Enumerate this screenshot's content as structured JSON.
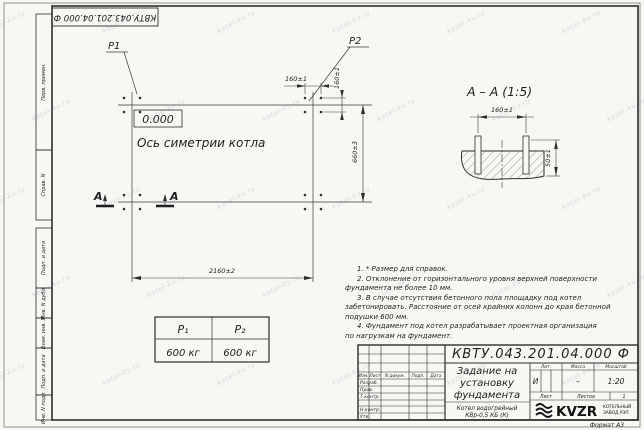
{
  "sheet": {
    "watermark": "kotel-kv.ru",
    "format": "Формат А3"
  },
  "top_stamp": {
    "doc_number": "КВТУ.043.201.04.000 Ф"
  },
  "sidebar": {
    "items": [
      "Перв. примен.",
      "Справ. N",
      "Подп. и дата",
      "Инв. N дубл.",
      "Взам. инв. N",
      "Подп. и дата",
      "Инв. N подл."
    ]
  },
  "plan": {
    "p1": "P1",
    "p2": "P2",
    "elevation": "0.000",
    "axis_label": "Ось симетрии котла",
    "section_letter_left": "А",
    "section_letter_right": "А",
    "dim_bolt_h": "160±1",
    "dim_bolt_v": "160±1",
    "dim_width": "660±3",
    "dim_length": "2160±2"
  },
  "section_view": {
    "title": "А – А (1:5)",
    "dim_bolts": "160±1",
    "dim_height": "50±1"
  },
  "notes": {
    "lines": [
      "1. * Размер для справок.",
      "2. Отклонение от горизонтального уровня верхней поверхности",
      "фундамента не более 10 мм.",
      "3. В случае отсутствия бетонного пола площадку под котел",
      "забетонировать. Расстояние от осей крайних колонн до края бетонной",
      "подушки 600 мм.",
      "4. Фундамент под котел разрабатывает проектная организация",
      "по нагрузкам на фундамент."
    ]
  },
  "load_table": {
    "col1_header": "P₁",
    "col2_header": "P₂",
    "col1_value": "600 кг",
    "col2_value": "600 кг"
  },
  "title_block": {
    "doc_number": "КВТУ.043.201.04.000 Ф",
    "title_line1": "Задание на",
    "title_line2": "установку",
    "title_line3": "фундамента",
    "product_line1": "Котел водогрейный",
    "product_line2": "КВр-0,5 КБ (К)",
    "header_izm": "Изм.",
    "header_list": "Лист",
    "header_doc": "N докум.",
    "header_podp": "Подп.",
    "header_data": "Дата",
    "row_razrab": "Разраб.",
    "row_prov": "Пров.",
    "row_tkontr": "Т.контр.",
    "row_nkontr": "Н.контр.",
    "row_utv": "Утв.",
    "lit_header": "Лит.",
    "mass_header": "Масса",
    "scale_header": "Масштаб",
    "lit_value": "И",
    "mass_value": "–",
    "scale_value": "1:20",
    "sheet_label": "Лист",
    "sheets_label": "Листов",
    "sheets_value": "1",
    "logo_text": "KVZR",
    "logo_sub1": "КОТЕЛЬНЫЙ",
    "logo_sub2": "ЗАВОД РЭП"
  }
}
